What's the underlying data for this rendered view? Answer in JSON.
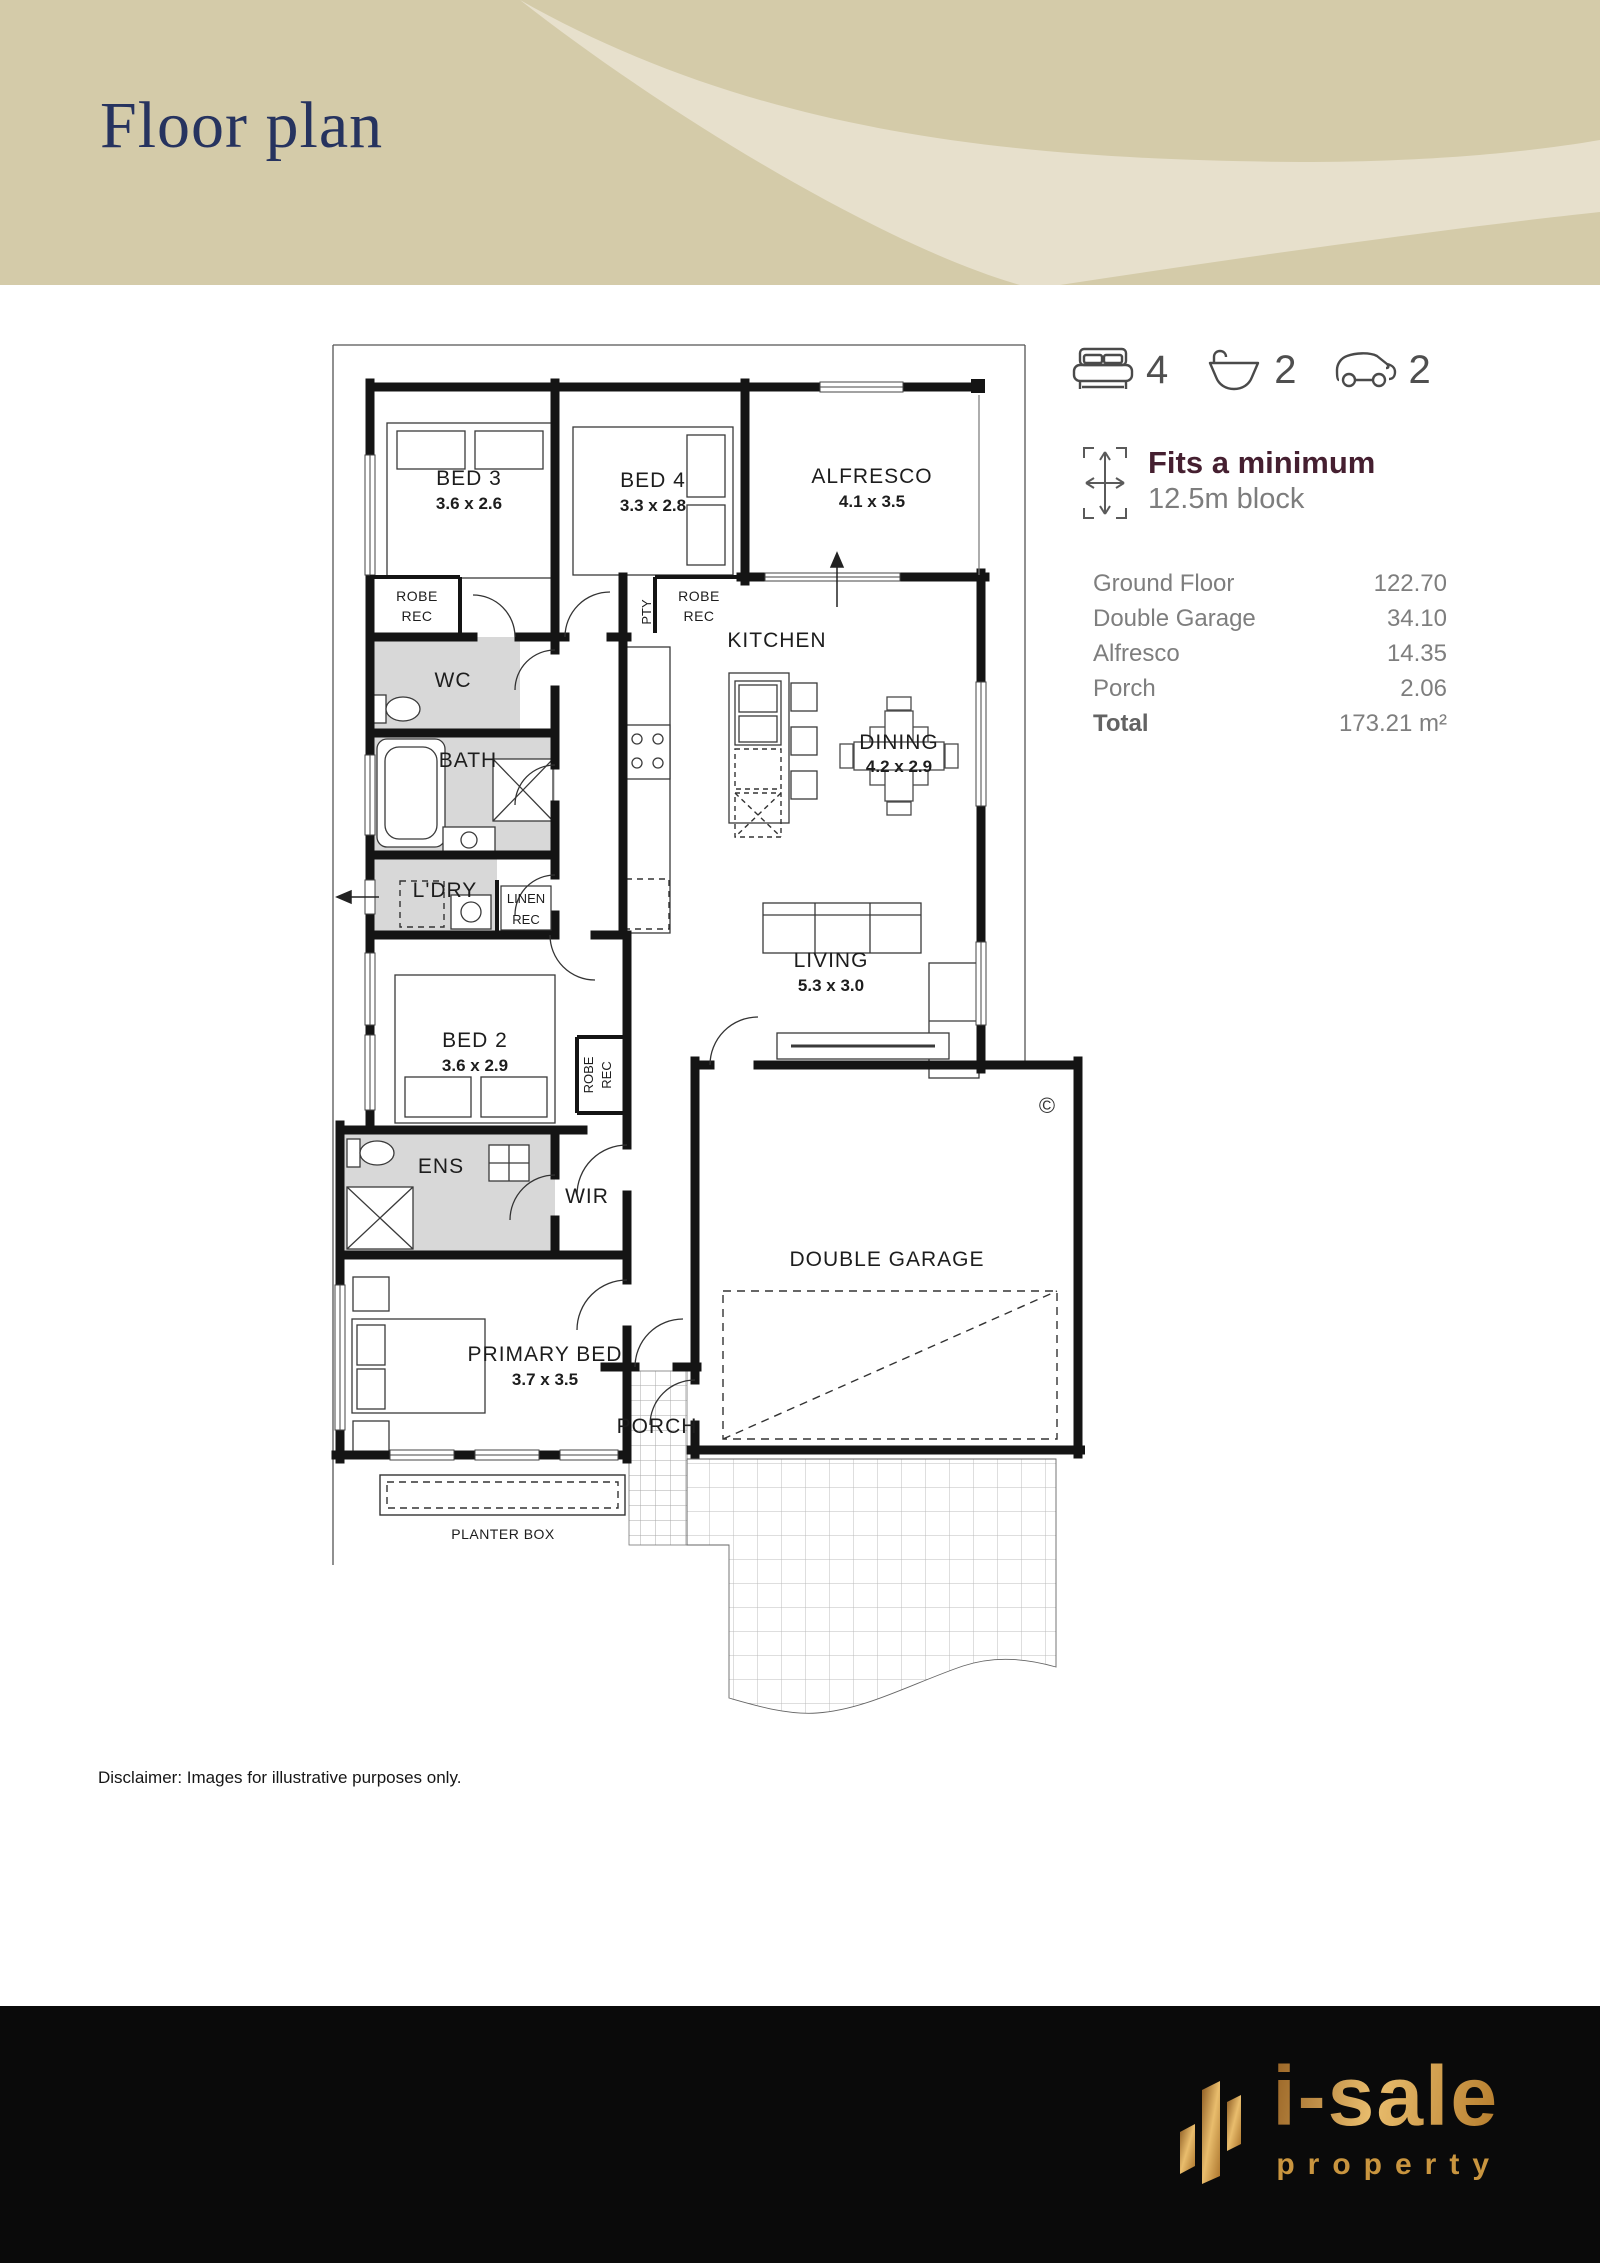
{
  "header": {
    "title": "Floor plan"
  },
  "stats": {
    "beds": "4",
    "baths": "2",
    "cars": "2"
  },
  "block_fit": {
    "heading": "Fits a minimum",
    "block": "12.5m block"
  },
  "areas": {
    "rows": [
      {
        "label": "Ground Floor",
        "value": "122.70"
      },
      {
        "label": "Double Garage",
        "value": "34.10"
      },
      {
        "label": "Alfresco",
        "value": "14.35"
      },
      {
        "label": "Porch",
        "value": "2.06"
      }
    ],
    "total": {
      "label": "Total",
      "value": "173.21 m²"
    }
  },
  "plan": {
    "rooms": {
      "bed3": {
        "name": "BED 3",
        "dims": "3.6 x 2.6"
      },
      "bed4": {
        "name": "BED 4",
        "dims": "3.3 x 2.8"
      },
      "alfresco": {
        "name": "ALFRESCO",
        "dims": "4.1 x 3.5"
      },
      "kitchen": {
        "name": "KITCHEN"
      },
      "dining": {
        "name": "DINING",
        "dims": "4.2 x 2.9"
      },
      "living": {
        "name": "LIVING",
        "dims": "5.3 x 3.0"
      },
      "bed2": {
        "name": "BED 2",
        "dims": "3.6 x 2.9"
      },
      "primary": {
        "name": "PRIMARY BED",
        "dims": "3.7 x 3.5"
      },
      "garage": {
        "name": "DOUBLE GARAGE"
      },
      "porch": {
        "name": "PORCH"
      },
      "planter": {
        "name": "PLANTER BOX"
      }
    },
    "labels": {
      "robe": "ROBE",
      "rec": "REC",
      "linen": "LINEN",
      "wc": "WC",
      "bath": "BATH",
      "laundry": "L'DRY",
      "ens": "ENS",
      "wir": "WIR",
      "pantry": "PTY"
    },
    "copyright_symbol": "©"
  },
  "disclaimer": "Disclaimer: Images for illustrative purposes only.",
  "footer": {
    "brand": "i-sale",
    "tagline": "property"
  },
  "colors": {
    "header_bg": "#d4cba9",
    "header_band": "#e7e0cc",
    "title": "#26335f",
    "accent_maroon": "#451f30",
    "text_gray": "#7e7e7e",
    "wall": "#141414",
    "wet_area": "#d8d8d8",
    "footer_bg": "#0a0a0a",
    "gold": "#c9953f"
  }
}
